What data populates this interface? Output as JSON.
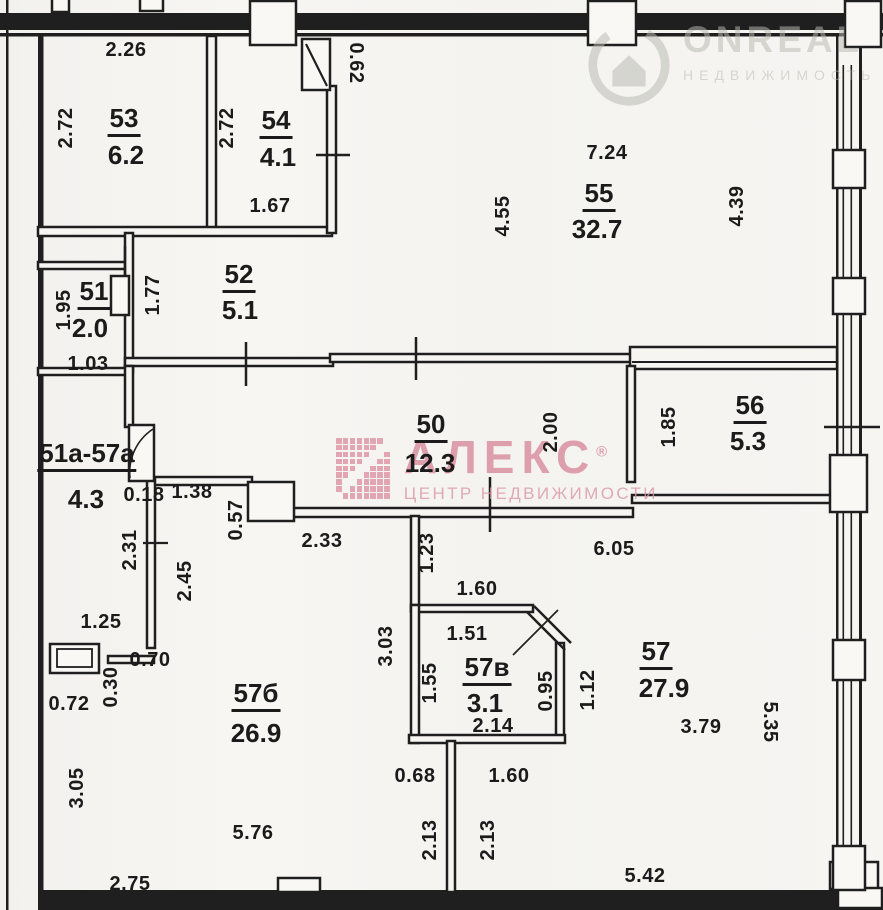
{
  "watermarks": {
    "onreal": {
      "brand": "ONREAL",
      "subtitle": "НЕДВИЖИМОСТЬ",
      "color": "#b9b9b2"
    },
    "aleks": {
      "brand": "АЛЕКС",
      "reg_mark": "®",
      "subtitle": "ЦЕНТР НЕДВИЖИМОСТИ",
      "color": "#d88b9b"
    }
  },
  "rooms": [
    {
      "number": "53",
      "area": "6.2",
      "nx": 124,
      "ny": 121,
      "ax": 126,
      "ay": 155
    },
    {
      "number": "54",
      "area": "4.1",
      "nx": 276,
      "ny": 123,
      "ax": 278,
      "ay": 157
    },
    {
      "number": "55",
      "area": "32.7",
      "nx": 599,
      "ny": 196,
      "ax": 597,
      "ay": 229
    },
    {
      "number": "51",
      "area": "2.0",
      "nx": 94,
      "ny": 294,
      "ax": 90,
      "ay": 328
    },
    {
      "number": "52",
      "area": "5.1",
      "nx": 239,
      "ny": 277,
      "ax": 240,
      "ay": 310
    },
    {
      "number": "50",
      "area": "12.3",
      "nx": 431,
      "ny": 427,
      "ax": 430,
      "ay": 463
    },
    {
      "number": "56",
      "area": "5.3",
      "nx": 750,
      "ny": 408,
      "ax": 748,
      "ay": 441
    },
    {
      "number": "51а-57а",
      "area": "4.3",
      "nx": 87,
      "ny": 456,
      "ax": 86,
      "ay": 499
    },
    {
      "number": "57б",
      "area": "26.9",
      "nx": 256,
      "ny": 696,
      "ax": 256,
      "ay": 733
    },
    {
      "number": "57в",
      "area": "3.1",
      "nx": 487,
      "ny": 670,
      "ax": 485,
      "ay": 703
    },
    {
      "number": "57",
      "area": "27.9",
      "nx": 656,
      "ny": 654,
      "ax": 664,
      "ay": 688
    }
  ],
  "dimensions": [
    {
      "text": "2.26",
      "x": 126,
      "y": 50,
      "rot": 0
    },
    {
      "text": "2.72",
      "x": 66,
      "y": 128,
      "rot": -90
    },
    {
      "text": "2.72",
      "x": 227,
      "y": 128,
      "rot": -90
    },
    {
      "text": "0.62",
      "x": 356,
      "y": 63,
      "rot": 90
    },
    {
      "text": "1.67",
      "x": 270,
      "y": 206,
      "rot": 0
    },
    {
      "text": "7.24",
      "x": 607,
      "y": 153,
      "rot": 0
    },
    {
      "text": "4.55",
      "x": 503,
      "y": 216,
      "rot": -90
    },
    {
      "text": "4.39",
      "x": 737,
      "y": 206,
      "rot": -90
    },
    {
      "text": "1.95",
      "x": 64,
      "y": 310,
      "rot": -90
    },
    {
      "text": "1.03",
      "x": 88,
      "y": 364,
      "rot": 0
    },
    {
      "text": "1.77",
      "x": 153,
      "y": 295,
      "rot": -90
    },
    {
      "text": "2.00",
      "x": 551,
      "y": 432,
      "rot": -90
    },
    {
      "text": "1.85",
      "x": 669,
      "y": 427,
      "rot": -90
    },
    {
      "text": "0.18",
      "x": 144,
      "y": 495,
      "rot": 0
    },
    {
      "text": "1.38",
      "x": 192,
      "y": 492,
      "rot": 0
    },
    {
      "text": "0.57",
      "x": 236,
      "y": 520,
      "rot": -90
    },
    {
      "text": "2.33",
      "x": 322,
      "y": 541,
      "rot": 0
    },
    {
      "text": "6.05",
      "x": 614,
      "y": 549,
      "rot": 0
    },
    {
      "text": "2.31",
      "x": 130,
      "y": 550,
      "rot": -90
    },
    {
      "text": "2.45",
      "x": 185,
      "y": 581,
      "rot": -90
    },
    {
      "text": "1.25",
      "x": 101,
      "y": 622,
      "rot": 0
    },
    {
      "text": "0.70",
      "x": 150,
      "y": 660,
      "rot": 0
    },
    {
      "text": "0.30",
      "x": 111,
      "y": 687,
      "rot": -90
    },
    {
      "text": "0.72",
      "x": 69,
      "y": 704,
      "rot": 0
    },
    {
      "text": "3.05",
      "x": 77,
      "y": 788,
      "rot": -90
    },
    {
      "text": "1.23",
      "x": 427,
      "y": 553,
      "rot": -90
    },
    {
      "text": "1.60",
      "x": 477,
      "y": 589,
      "rot": 0
    },
    {
      "text": "1.51",
      "x": 467,
      "y": 634,
      "rot": 0
    },
    {
      "text": "3.03",
      "x": 386,
      "y": 646,
      "rot": -90
    },
    {
      "text": "1.55",
      "x": 430,
      "y": 683,
      "rot": -90
    },
    {
      "text": "0.95",
      "x": 546,
      "y": 691,
      "rot": -90
    },
    {
      "text": "1.12",
      "x": 588,
      "y": 690,
      "rot": -90
    },
    {
      "text": "2.14",
      "x": 493,
      "y": 726,
      "rot": 0
    },
    {
      "text": "3.79",
      "x": 701,
      "y": 727,
      "rot": 0
    },
    {
      "text": "5.35",
      "x": 770,
      "y": 722,
      "rot": 90
    },
    {
      "text": "0.68",
      "x": 415,
      "y": 776,
      "rot": 0
    },
    {
      "text": "1.60",
      "x": 509,
      "y": 776,
      "rot": 0
    },
    {
      "text": "2.13",
      "x": 430,
      "y": 840,
      "rot": -90
    },
    {
      "text": "2.13",
      "x": 488,
      "y": 840,
      "rot": -90
    },
    {
      "text": "5.76",
      "x": 253,
      "y": 833,
      "rot": 0
    },
    {
      "text": "2.75",
      "x": 130,
      "y": 884,
      "rot": 0
    },
    {
      "text": "5.42",
      "x": 645,
      "y": 876,
      "rot": 0
    }
  ]
}
